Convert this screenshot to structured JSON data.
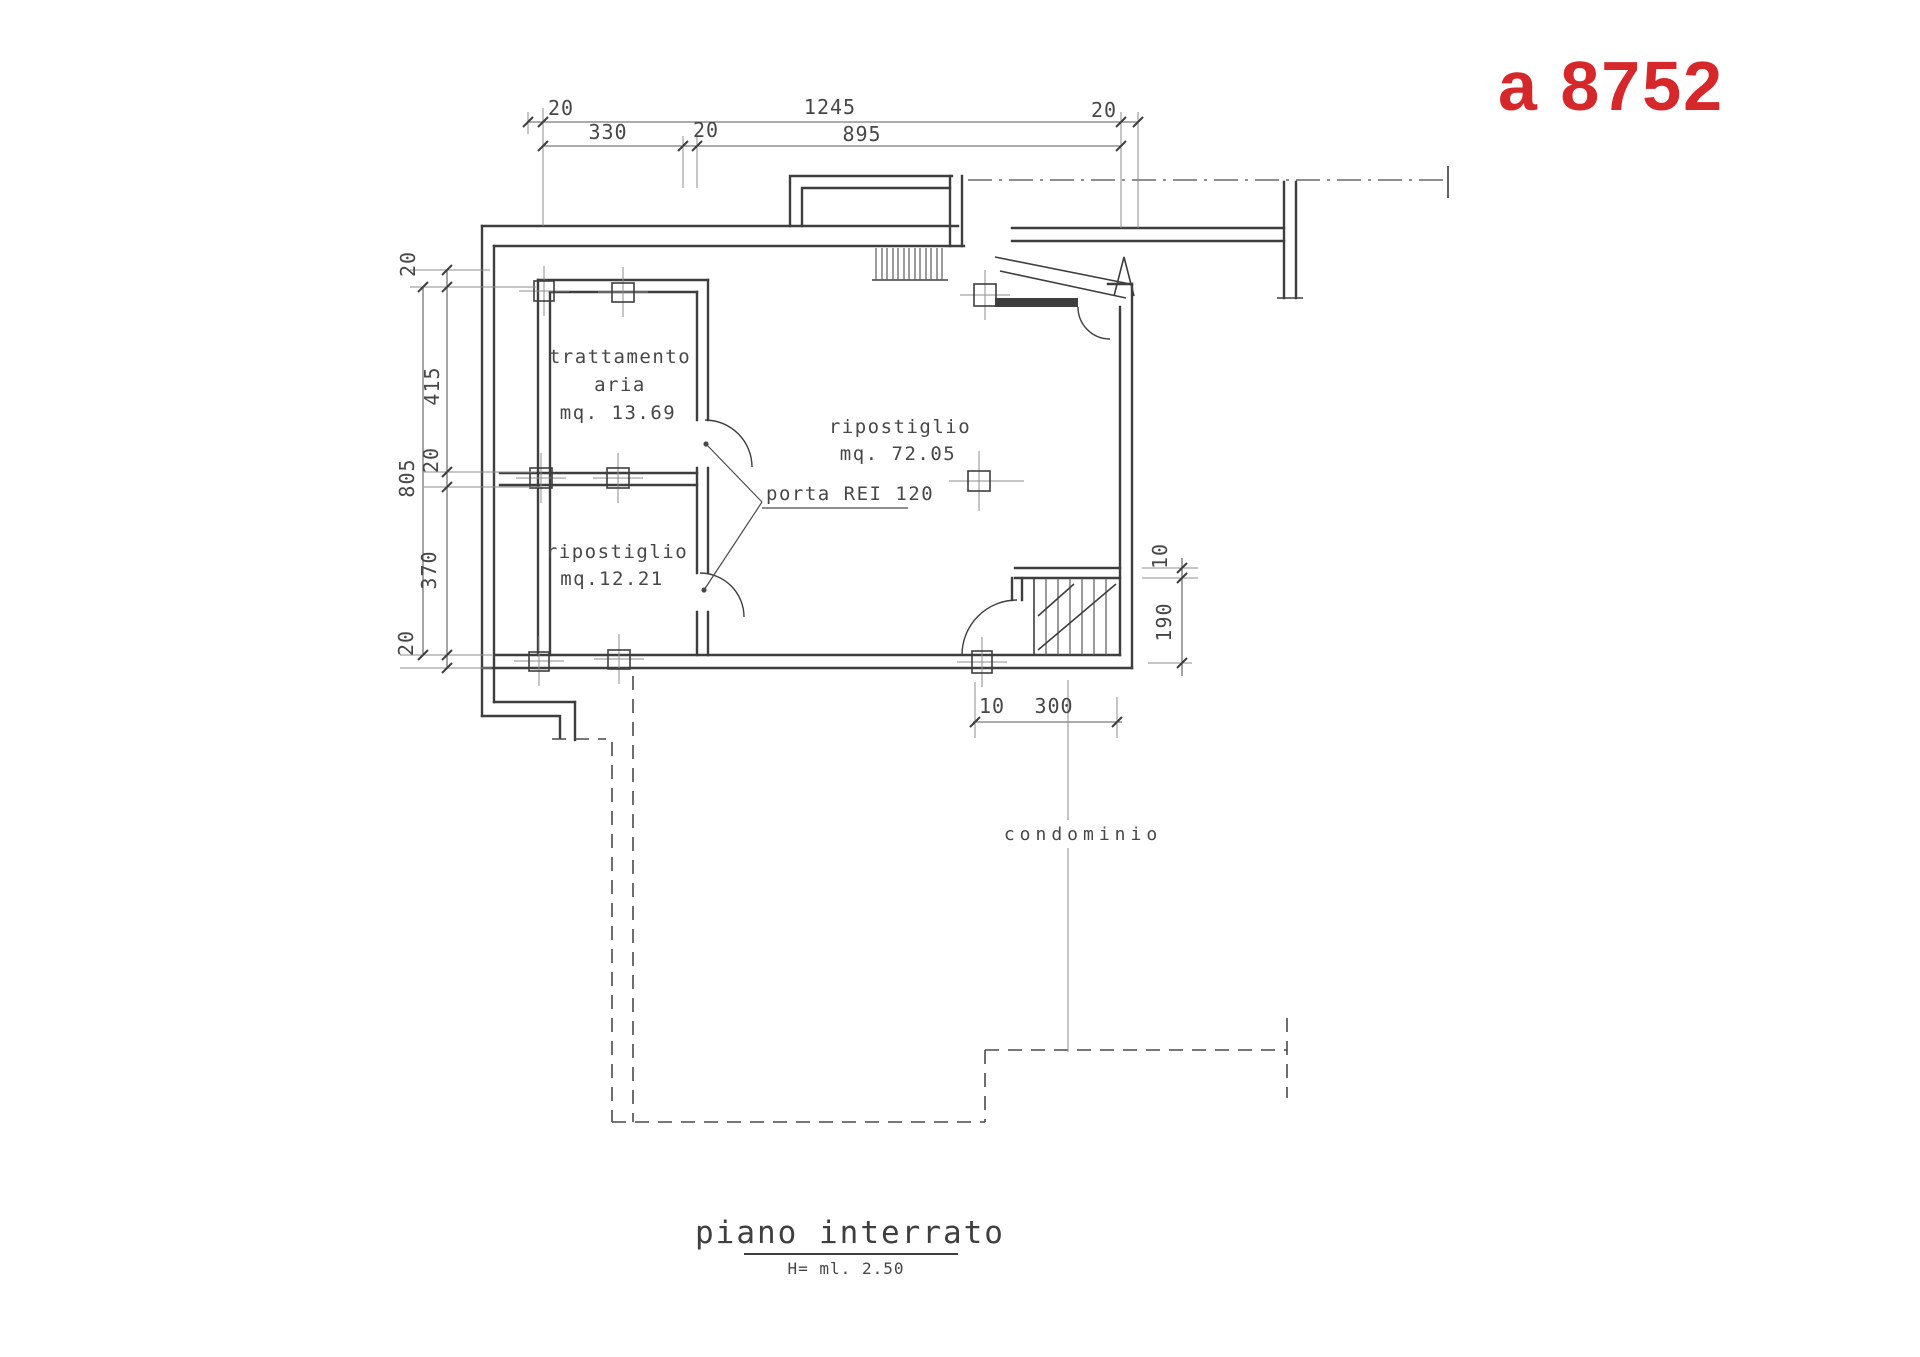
{
  "stamp": {
    "code": "a 8752",
    "color": "#d6272b"
  },
  "plan": {
    "rooms": {
      "air_treatment": {
        "name_line1": "trattamento",
        "name_line2": "aria",
        "area": "mq. 13.69"
      },
      "storage_large": {
        "name": "ripostiglio",
        "area": "mq. 72.05"
      },
      "storage_small": {
        "name": "ripostiglio",
        "area": "mq.12.21"
      }
    },
    "labels": {
      "fire_door": "porta REI 120",
      "common_area": "condominio"
    }
  },
  "dimensions": {
    "top_row1": [
      "20",
      "1245",
      "20"
    ],
    "top_row2": [
      "330",
      "20",
      "895"
    ],
    "left": [
      "20",
      "415",
      "20",
      "805",
      "370",
      "20"
    ],
    "right": [
      "10",
      "190"
    ],
    "bottom": [
      "10",
      "300"
    ]
  },
  "title_block": {
    "title": "piano interrato",
    "height": "H= ml. 2.50"
  },
  "colors": {
    "ink": "#3e3e3e",
    "light_line": "#8d8d8d",
    "text": "#474747",
    "stamp_red": "#d6272b",
    "background": "#ffffff"
  }
}
